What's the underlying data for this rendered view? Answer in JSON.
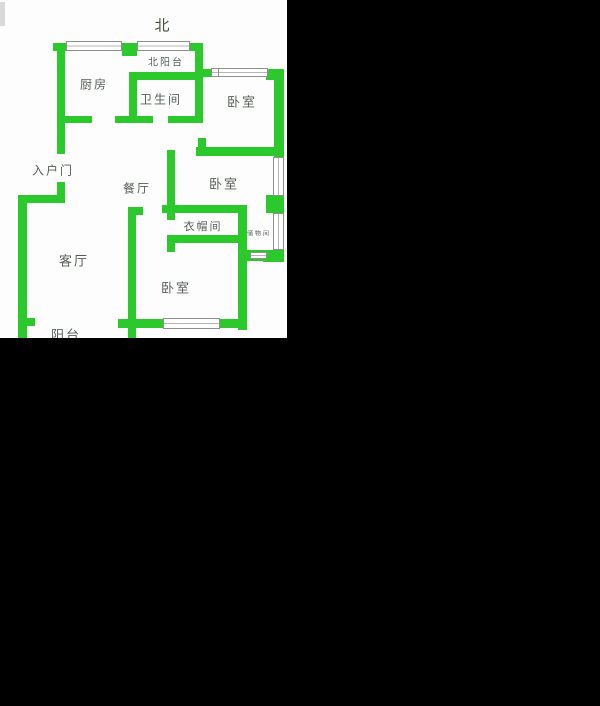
{
  "canvas": {
    "width": 600,
    "height": 706,
    "background": "#000000"
  },
  "floorplan": {
    "x": 0,
    "y": 0,
    "width": 287,
    "height": 338,
    "background": "#fdfdfd",
    "wall_color": "#2cc92c",
    "window_border_color": "#8f8f8f",
    "label_color": "#575f57",
    "compass": {
      "label": "北",
      "x": 162,
      "y": 25
    },
    "rooms": [
      {
        "id": "north-balcony",
        "label": "北阳台",
        "x": 166,
        "y": 61,
        "size": 10
      },
      {
        "id": "kitchen",
        "label": "厨房",
        "x": 94,
        "y": 84,
        "size": 12
      },
      {
        "id": "bathroom",
        "label": "卫生间",
        "x": 161,
        "y": 99,
        "size": 12
      },
      {
        "id": "bedroom-north",
        "label": "卧室",
        "x": 242,
        "y": 101,
        "size": 13
      },
      {
        "id": "entry-door",
        "label": "入户门",
        "x": 53,
        "y": 170,
        "size": 12
      },
      {
        "id": "dining",
        "label": "餐厅",
        "x": 137,
        "y": 188,
        "size": 12
      },
      {
        "id": "bedroom-east",
        "label": "卧室",
        "x": 224,
        "y": 183,
        "size": 13
      },
      {
        "id": "cloakroom",
        "label": "衣帽间",
        "x": 203,
        "y": 226,
        "size": 11
      },
      {
        "id": "storage",
        "label": "储物间",
        "x": 259,
        "y": 233,
        "size": 6
      },
      {
        "id": "living",
        "label": "客厅",
        "x": 74,
        "y": 260,
        "size": 13
      },
      {
        "id": "bedroom-south",
        "label": "卧室",
        "x": 176,
        "y": 287,
        "size": 13
      },
      {
        "id": "balcony",
        "label": "阳台",
        "x": 66,
        "y": 334,
        "size": 13
      }
    ],
    "walls": [
      {
        "x": 53,
        "y": 43,
        "w": 150,
        "h": 8
      },
      {
        "x": 122,
        "y": 43,
        "w": 15,
        "h": 13
      },
      {
        "x": 129,
        "y": 72,
        "w": 74,
        "h": 8
      },
      {
        "x": 196,
        "y": 69,
        "w": 22,
        "h": 8
      },
      {
        "x": 266,
        "y": 69,
        "w": 18,
        "h": 11
      },
      {
        "x": 57,
        "y": 116,
        "w": 35,
        "h": 7
      },
      {
        "x": 115,
        "y": 116,
        "w": 38,
        "h": 7
      },
      {
        "x": 168,
        "y": 116,
        "w": 35,
        "h": 7
      },
      {
        "x": 196,
        "y": 147,
        "w": 82,
        "h": 9
      },
      {
        "x": 162,
        "y": 205,
        "w": 85,
        "h": 8
      },
      {
        "x": 167,
        "y": 235,
        "w": 80,
        "h": 8
      },
      {
        "x": 18,
        "y": 195,
        "w": 47,
        "h": 8
      },
      {
        "x": 128,
        "y": 207,
        "w": 15,
        "h": 8
      },
      {
        "x": 240,
        "y": 250,
        "w": 44,
        "h": 11
      },
      {
        "x": 263,
        "y": 250,
        "w": 21,
        "h": 12
      },
      {
        "x": 27,
        "y": 318,
        "w": 8,
        "h": 8
      },
      {
        "x": 118,
        "y": 319,
        "w": 45,
        "h": 9
      },
      {
        "x": 220,
        "y": 319,
        "w": 27,
        "h": 9
      },
      {
        "x": 266,
        "y": 195,
        "w": 18,
        "h": 18
      },
      {
        "x": 57,
        "y": 43,
        "w": 8,
        "h": 111
      },
      {
        "x": 129,
        "y": 72,
        "w": 8,
        "h": 51
      },
      {
        "x": 195,
        "y": 43,
        "w": 8,
        "h": 80
      },
      {
        "x": 198,
        "y": 138,
        "w": 8,
        "h": 9
      },
      {
        "x": 167,
        "y": 150,
        "w": 8,
        "h": 70
      },
      {
        "x": 167,
        "y": 243,
        "w": 8,
        "h": 9
      },
      {
        "x": 238,
        "y": 205,
        "w": 9,
        "h": 125
      },
      {
        "x": 128,
        "y": 207,
        "w": 8,
        "h": 131
      },
      {
        "x": 57,
        "y": 182,
        "w": 8,
        "h": 21
      },
      {
        "x": 18,
        "y": 195,
        "w": 9,
        "h": 143
      },
      {
        "x": 274,
        "y": 72,
        "w": 10,
        "h": 85
      }
    ],
    "windows": [
      {
        "x": 66,
        "y": 41,
        "w": 56,
        "h": 10,
        "o": "h"
      },
      {
        "x": 137,
        "y": 41,
        "w": 53,
        "h": 10,
        "o": "h"
      },
      {
        "x": 211,
        "y": 68,
        "w": 9,
        "h": 9,
        "o": "h"
      },
      {
        "x": 218,
        "y": 68,
        "w": 50,
        "h": 9,
        "o": "h"
      },
      {
        "x": 273,
        "y": 157,
        "w": 11,
        "h": 39,
        "o": "v"
      },
      {
        "x": 273,
        "y": 213,
        "w": 11,
        "h": 37,
        "o": "v"
      },
      {
        "x": 250,
        "y": 252,
        "w": 17,
        "h": 7,
        "o": "h"
      },
      {
        "x": 163,
        "y": 318,
        "w": 57,
        "h": 11,
        "o": "h"
      }
    ],
    "corner_mark": {
      "x": 0,
      "y": 2,
      "w": 5,
      "h": 24
    }
  }
}
